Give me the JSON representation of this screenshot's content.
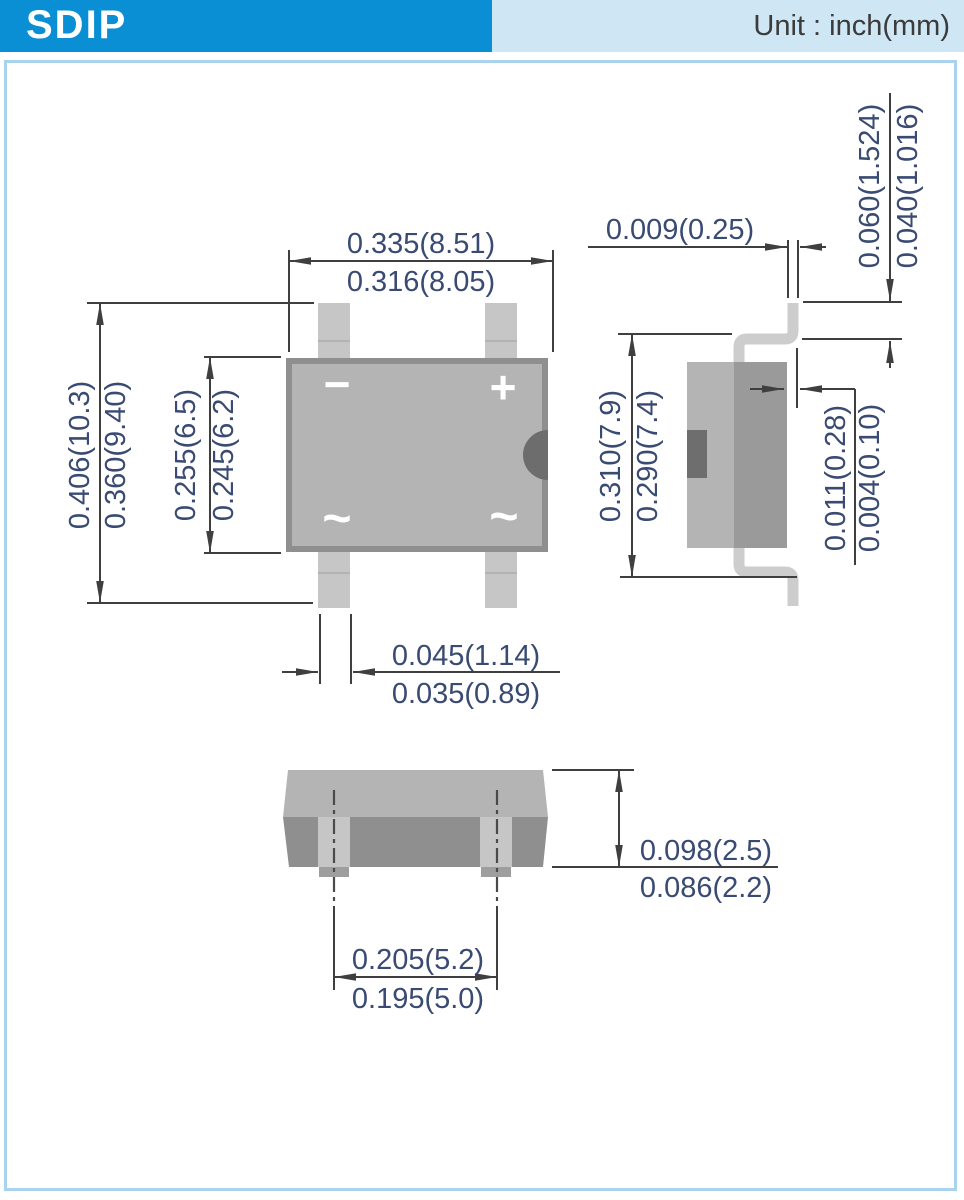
{
  "header": {
    "title": "SDIP",
    "unit_label": "Unit : inch(mm)"
  },
  "colors": {
    "header_blue": "#0b8fd4",
    "header_light_blue": "#cfe6f5",
    "frame_border": "#a9d2ec",
    "line": "#3f3f3f",
    "dimension_text": "#394a73",
    "body_gray": "#b4b4b4",
    "body_edge": "#8f8f8f",
    "pin_gray": "#c6c6c6",
    "side_dark_face": "#9a9a9a",
    "recess_dark": "#6e6e6e",
    "lead_gray": "#cdcdcd",
    "notch_dark": "#6d6d6d",
    "end_front_face": "#8f8f8f",
    "tab_gray": "#9e9e9e"
  },
  "front_view": {
    "width_max": "0.335(8.51)",
    "width_min": "0.316(8.05)",
    "height_max": "0.406(10.3)",
    "height_min": "0.360(9.40)",
    "body_height_max": "0.255(6.5)",
    "body_height_min": "0.245(6.2)",
    "pin_width_max": "0.045(1.14)",
    "pin_width_min": "0.035(0.89)",
    "marking_minus": "−",
    "marking_plus": "+",
    "marking_ac1": "~",
    "marking_ac2": "~"
  },
  "side_view": {
    "lead_thickness": "0.009(0.25)",
    "lead_top_max": "0.060(1.524)",
    "lead_top_min": "0.040(1.016)",
    "depth_max": "0.310(7.9)",
    "depth_min": "0.290(7.4)",
    "standoff_max": "0.011(0.28)",
    "standoff_min": "0.004(0.10)"
  },
  "end_view": {
    "height_max": "0.098(2.5)",
    "height_min": "0.086(2.2)",
    "pitch_max": "0.205(5.2)",
    "pitch_min": "0.195(5.0)"
  }
}
